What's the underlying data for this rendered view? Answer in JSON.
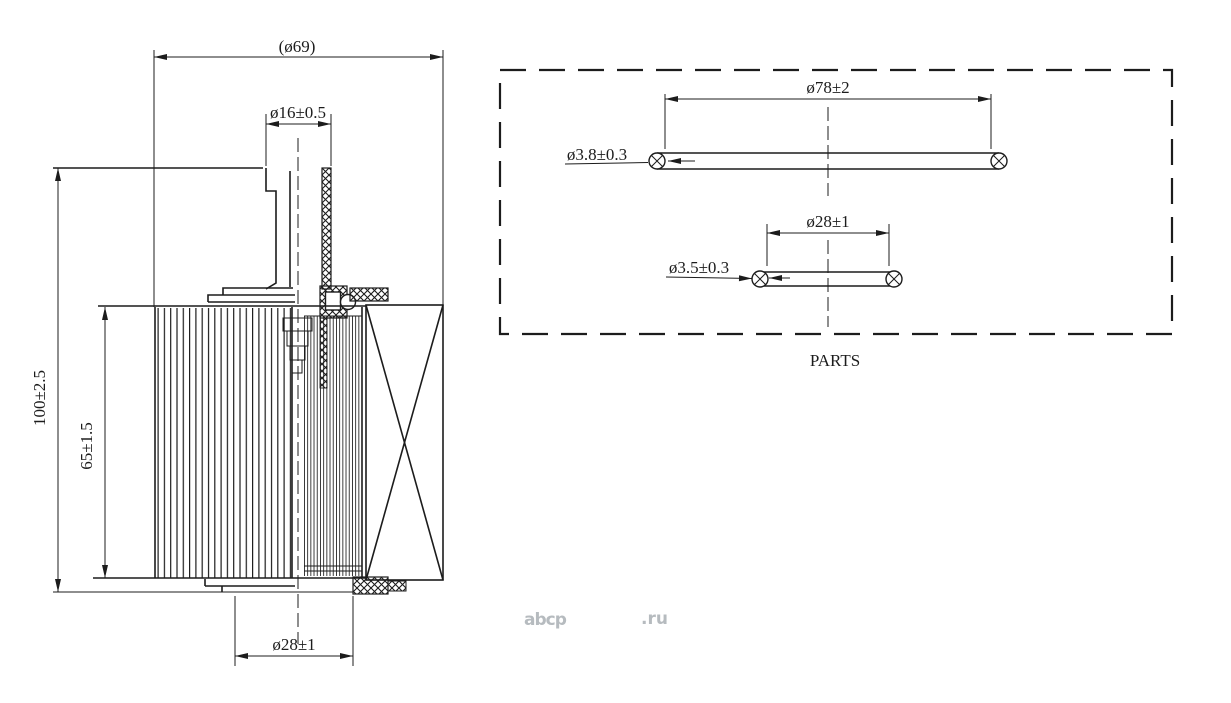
{
  "main_view": {
    "dims": {
      "overall_diameter": "(ø69)",
      "tube_diameter": "ø16±0.5",
      "overall_height": "100±2.5",
      "element_height": "65±1.5",
      "bottom_bore_diameter": "ø28±1"
    }
  },
  "parts_box": {
    "title": "PARTS",
    "oring_large": {
      "outer_diameter": "ø78±2",
      "cord_diameter": "ø3.8±0.3"
    },
    "oring_small": {
      "outer_diameter": "ø28±1",
      "cord_diameter": "ø3.5±0.3"
    }
  },
  "watermark": {
    "brand": "abcp",
    "tld": ".ru"
  },
  "colors": {
    "line": "#1c1c1c",
    "watermark": "#b6bbbf",
    "background": "#ffffff"
  }
}
